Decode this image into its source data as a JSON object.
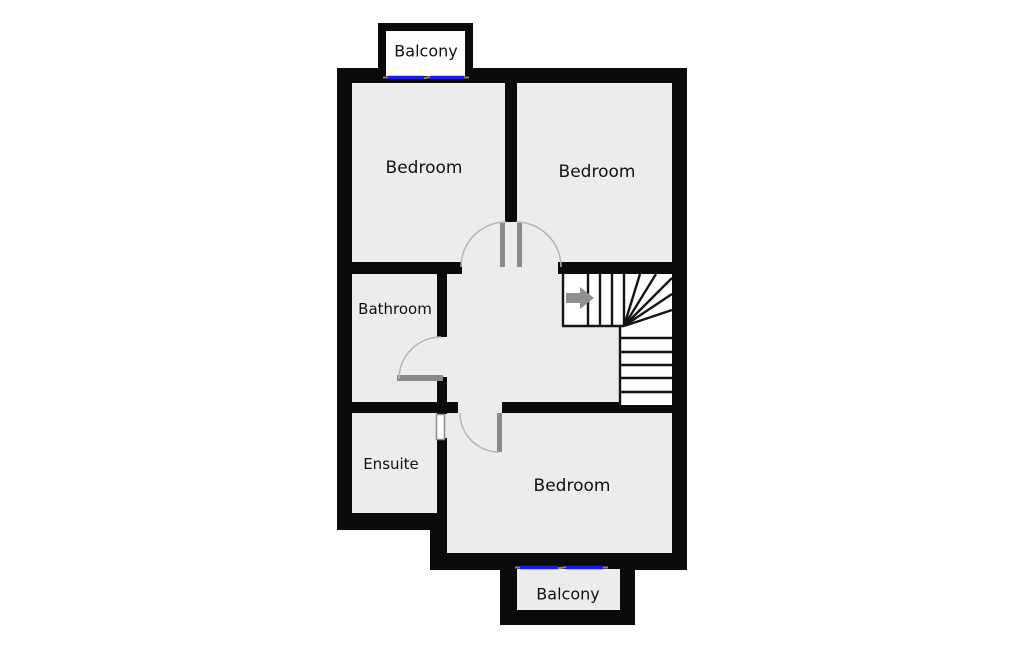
{
  "plan": {
    "type": "floor-plan",
    "floor_features": [
      "stairs",
      "door-swings",
      "balcony-windows"
    ]
  },
  "rooms": [
    {
      "id": "balcony-top",
      "label": "Balcony"
    },
    {
      "id": "bedroom-top-left",
      "label": "Bedroom"
    },
    {
      "id": "bedroom-top-right",
      "label": "Bedroom"
    },
    {
      "id": "bathroom",
      "label": "Bathroom"
    },
    {
      "id": "ensuite",
      "label": "Ensuite"
    },
    {
      "id": "bedroom-bottom",
      "label": "Bedroom"
    },
    {
      "id": "balcony-bottom",
      "label": "Balcony"
    }
  ],
  "colors": {
    "wall": "#0a0a0a",
    "floor": "#ececec",
    "stair_white": "#ffffff",
    "window_blue": "#1a1af0",
    "door_gray": "#8a8a8a",
    "swing_arc": "#b5b5b5",
    "jamb_gray": "#8a8a7a"
  }
}
